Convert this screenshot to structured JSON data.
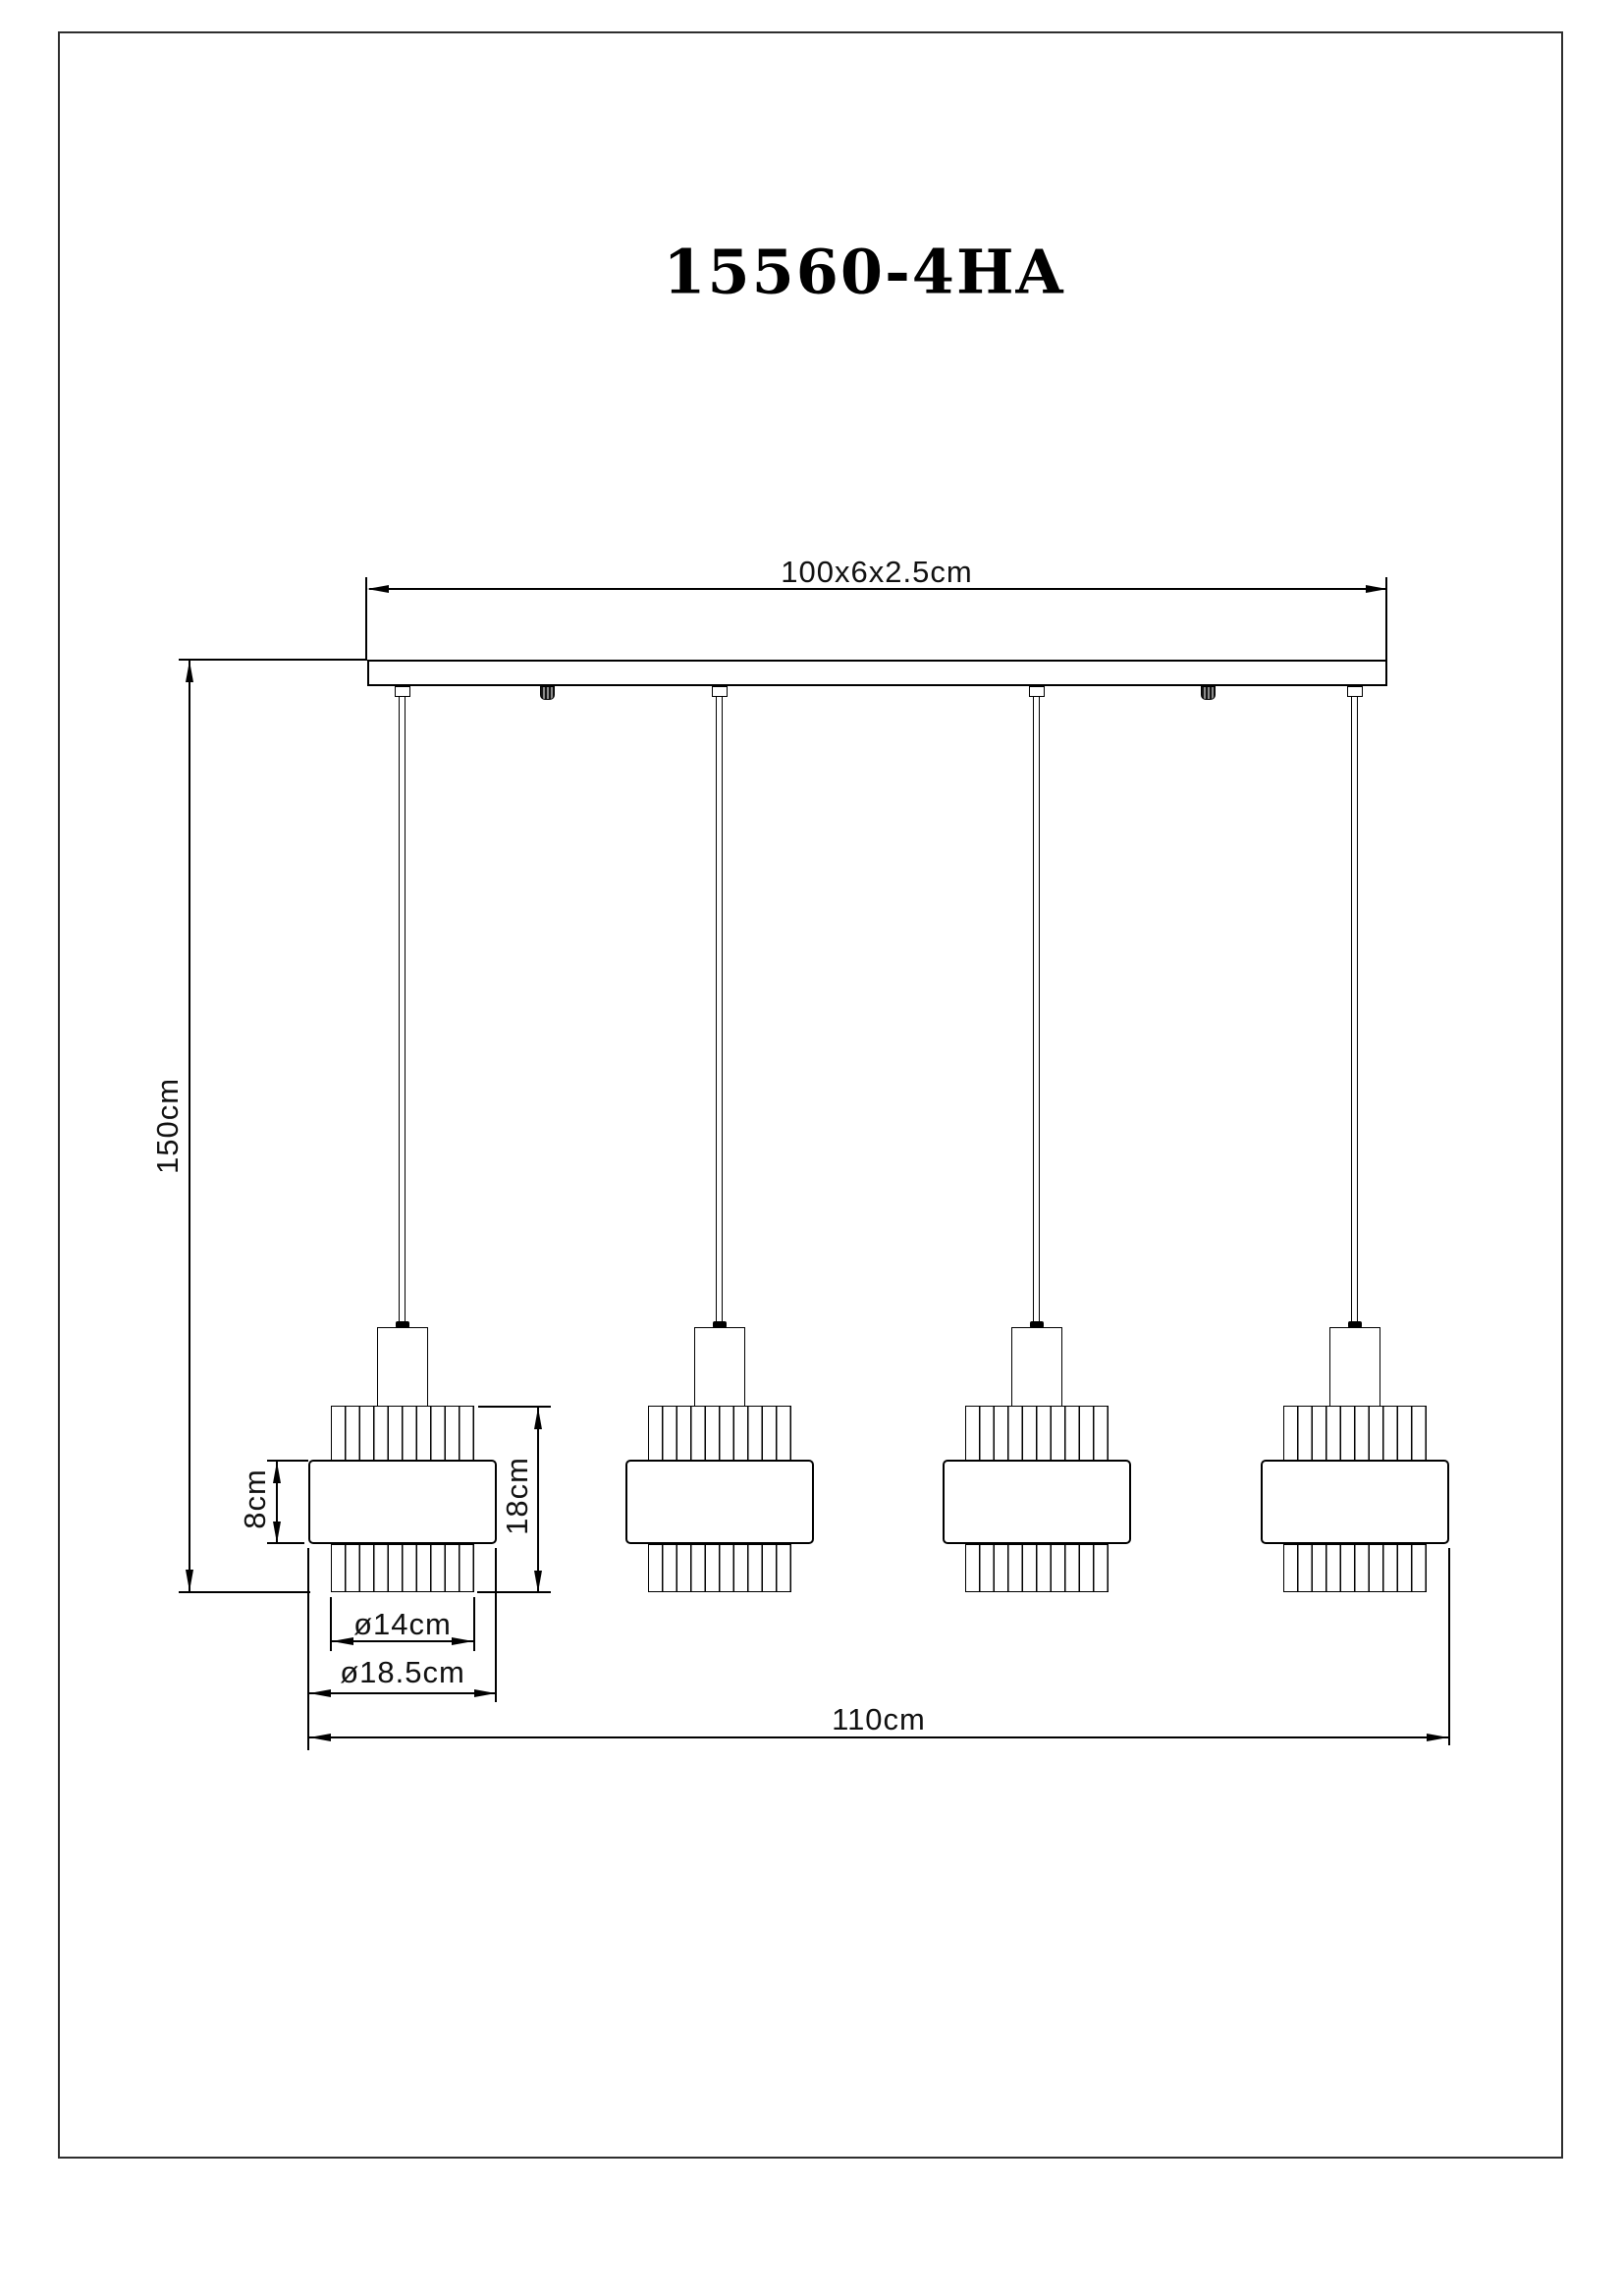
{
  "title": "15560-4HA",
  "lamp_count": 4,
  "colors": {
    "background": "#ffffff",
    "line": "#000000",
    "frame_border": "#2e2e2e",
    "text": "#111111"
  },
  "dimensions": {
    "canopy_size": "100x6x2.5cm",
    "drop_height": "150cm",
    "band_height": "8cm",
    "shade_height": "18cm",
    "shade_inner_diameter": "ø14cm",
    "shade_outer_diameter": "ø18.5cm",
    "overall_width": "110cm"
  }
}
